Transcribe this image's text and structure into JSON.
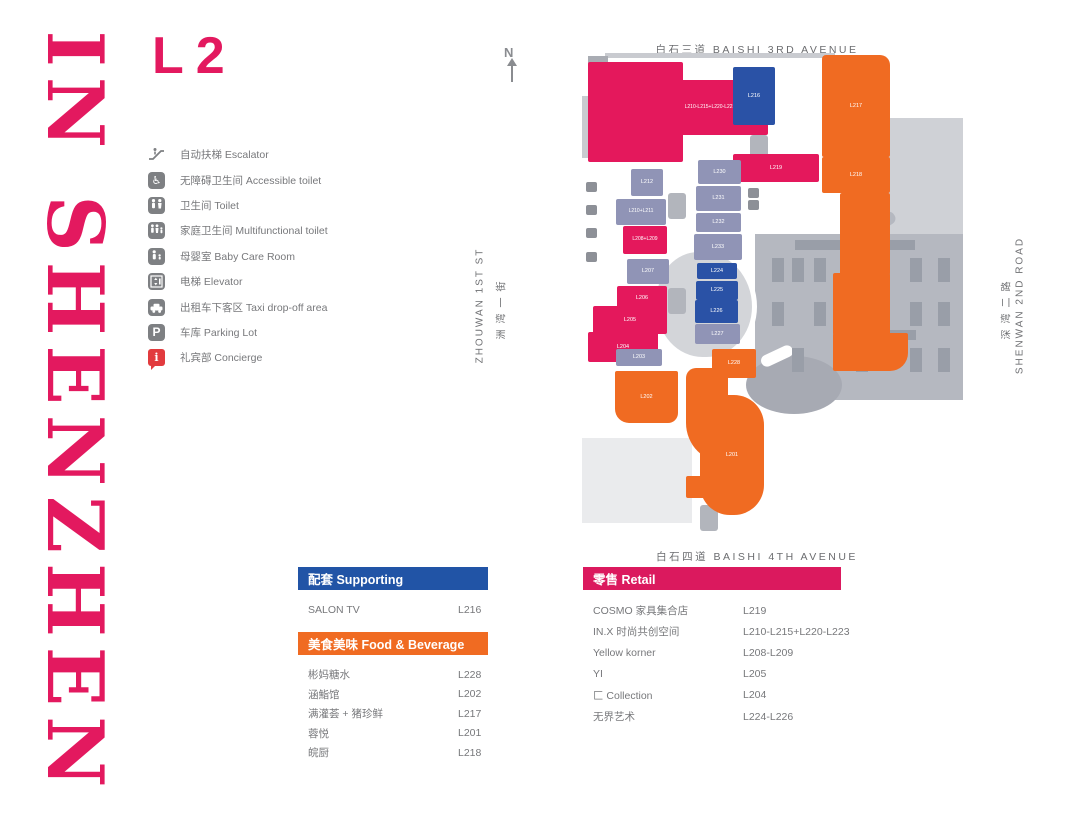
{
  "colors": {
    "brand_pink": "#E3195F",
    "unit_pink": "#E4185C",
    "unit_orange": "#F06B22",
    "unit_purple": "#9094B6",
    "unit_blue": "#2A52A6",
    "header_blue": "#2154A6",
    "header_orange": "#F06B22",
    "header_pink": "#DB195E",
    "concierge_red": "#E23B3E",
    "legend_gray": "#7E8083",
    "text_gray": "#77787B"
  },
  "brand": {
    "title": "IN SHENZHEN"
  },
  "floor_label": "L2",
  "compass": {
    "label": "N"
  },
  "legend": [
    {
      "zh": "自动扶梯",
      "en": "Escalator",
      "icon": "escalator-icon"
    },
    {
      "zh": "无障碍卫生间",
      "en": "Accessible toilet",
      "icon": "accessible-toilet-icon"
    },
    {
      "zh": "卫生间",
      "en": "Toilet",
      "icon": "toilet-icon"
    },
    {
      "zh": "家庭卫生间",
      "en": "Multifunctional toilet",
      "icon": "multifunctional-toilet-icon"
    },
    {
      "zh": "母婴室",
      "en": "Baby Care Room",
      "icon": "baby-care-icon"
    },
    {
      "zh": "电梯",
      "en": "Elevator",
      "icon": "elevator-icon"
    },
    {
      "zh": "出租车下客区",
      "en": "Taxi drop-off area",
      "icon": "taxi-icon"
    },
    {
      "zh": "车库",
      "en": "Parking Lot",
      "icon": "parking-icon"
    },
    {
      "zh": "礼宾部",
      "en": "Concierge",
      "icon": "concierge-icon"
    }
  ],
  "streets": {
    "top": {
      "zh": "白石三道",
      "en": "BAISHI 3RD AVENUE"
    },
    "bottom": {
      "zh": "白石四道",
      "en": "BAISHI 4TH AVENUE"
    },
    "left": {
      "zh": "洲湾一街",
      "en": "ZHOUWAN 1ST ST"
    },
    "right": {
      "zh": "深湾二路",
      "en": "SHENWAN 2ND ROAD"
    }
  },
  "map": {
    "units": [
      {
        "label": "",
        "cat": "retail",
        "x": 588,
        "y": 62,
        "w": 95,
        "h": 100
      },
      {
        "label": "L210-L215+L220-L223",
        "cat": "retail",
        "x": 652,
        "y": 80,
        "w": 116,
        "h": 55
      },
      {
        "label": "L208+L209",
        "cat": "retail",
        "x": 623,
        "y": 226,
        "w": 44,
        "h": 28
      },
      {
        "label": "L206",
        "cat": "retail",
        "x": 617,
        "y": 286,
        "w": 50,
        "h": 24
      },
      {
        "label": "L205",
        "cat": "retail",
        "x": 593,
        "y": 306,
        "w": 74,
        "h": 28
      },
      {
        "label": "L204",
        "cat": "retail",
        "x": 588,
        "y": 332,
        "w": 70,
        "h": 30
      },
      {
        "label": "L219",
        "cat": "retail",
        "x": 733,
        "y": 154,
        "w": 86,
        "h": 28
      },
      {
        "label": "L217",
        "cat": "fnb",
        "x": 822,
        "y": 55,
        "w": 68,
        "h": 102,
        "rad": "4px 10px 2px 2px"
      },
      {
        "label": "L218",
        "cat": "fnb",
        "x": 822,
        "y": 157,
        "w": 68,
        "h": 36
      },
      {
        "label": "",
        "cat": "fnb",
        "x": 840,
        "y": 193,
        "w": 50,
        "h": 82
      },
      {
        "label": "",
        "cat": "fnb",
        "x": 833,
        "y": 273,
        "w": 57,
        "h": 62
      },
      {
        "label": "",
        "cat": "fnb",
        "x": 833,
        "y": 333,
        "w": 75,
        "h": 38,
        "rad": "2px 2px 18px 2px"
      },
      {
        "label": "L202",
        "cat": "fnb",
        "x": 615,
        "y": 371,
        "w": 63,
        "h": 52,
        "rad": "2px 2px 10px 14px"
      },
      {
        "label": "",
        "cat": "fnb",
        "x": 686,
        "y": 368,
        "w": 42,
        "h": 95,
        "rad": "10px 2px 2px 40px"
      },
      {
        "label": "L201",
        "cat": "fnb",
        "x": 700,
        "y": 395,
        "w": 64,
        "h": 120,
        "rad": "2px 30px 30px 30px"
      },
      {
        "label": "",
        "cat": "fnb",
        "x": 686,
        "y": 476,
        "w": 24,
        "h": 22
      },
      {
        "label": "L228",
        "cat": "fnb",
        "x": 712,
        "y": 349,
        "w": 44,
        "h": 29
      },
      {
        "label": "L212",
        "cat": "vacant",
        "x": 631,
        "y": 169,
        "w": 32,
        "h": 27
      },
      {
        "label": "L210+L211",
        "cat": "vacant",
        "x": 616,
        "y": 199,
        "w": 50,
        "h": 26
      },
      {
        "label": "L207",
        "cat": "vacant",
        "x": 627,
        "y": 259,
        "w": 42,
        "h": 25
      },
      {
        "label": "L230",
        "cat": "vacant",
        "x": 698,
        "y": 160,
        "w": 43,
        "h": 24
      },
      {
        "label": "L231",
        "cat": "vacant",
        "x": 696,
        "y": 186,
        "w": 45,
        "h": 25
      },
      {
        "label": "L232",
        "cat": "vacant",
        "x": 696,
        "y": 213,
        "w": 45,
        "h": 19
      },
      {
        "label": "L233",
        "cat": "vacant",
        "x": 694,
        "y": 234,
        "w": 48,
        "h": 26
      },
      {
        "label": "L227",
        "cat": "vacant",
        "x": 695,
        "y": 324,
        "w": 45,
        "h": 20
      },
      {
        "label": "L203",
        "cat": "vacant",
        "x": 616,
        "y": 349,
        "w": 46,
        "h": 17
      },
      {
        "label": "L216",
        "cat": "support",
        "x": 733,
        "y": 67,
        "w": 42,
        "h": 58
      },
      {
        "label": "L224",
        "cat": "art",
        "x": 697,
        "y": 263,
        "w": 40,
        "h": 16
      },
      {
        "label": "L225",
        "cat": "art",
        "x": 696,
        "y": 281,
        "w": 42,
        "h": 19
      },
      {
        "label": "L226",
        "cat": "art",
        "x": 695,
        "y": 300,
        "w": 43,
        "h": 23
      }
    ],
    "metro_icon_label": "M"
  },
  "tables": {
    "supporting": {
      "title": "配套 Supporting",
      "rows": [
        {
          "name": "SALON TV",
          "code": "L216"
        }
      ]
    },
    "fnb": {
      "title": "美食美味 Food & Beverage",
      "rows": [
        {
          "name": "彬妈糖水",
          "code": "L228"
        },
        {
          "name": "涵鮨馆",
          "code": "L202"
        },
        {
          "name": "满灌荟 + 猪珍鲜",
          "code": "L217"
        },
        {
          "name": "蓉悦",
          "code": "L201"
        },
        {
          "name": "皖厨",
          "code": "L218"
        }
      ]
    },
    "retail": {
      "title": "零售 Retail",
      "rows": [
        {
          "name": "COSMO 家具集合店",
          "code": "L219"
        },
        {
          "name": "IN.X 时尚共创空间",
          "code": "L210-L215+L220-L223"
        },
        {
          "name": "Yellow korner",
          "code": "L208-L209"
        },
        {
          "name": "YI",
          "code": "L205"
        },
        {
          "name": "匚 Collection",
          "code": "L204"
        },
        {
          "name": "无界艺术",
          "code": "L224-L226"
        }
      ]
    }
  }
}
